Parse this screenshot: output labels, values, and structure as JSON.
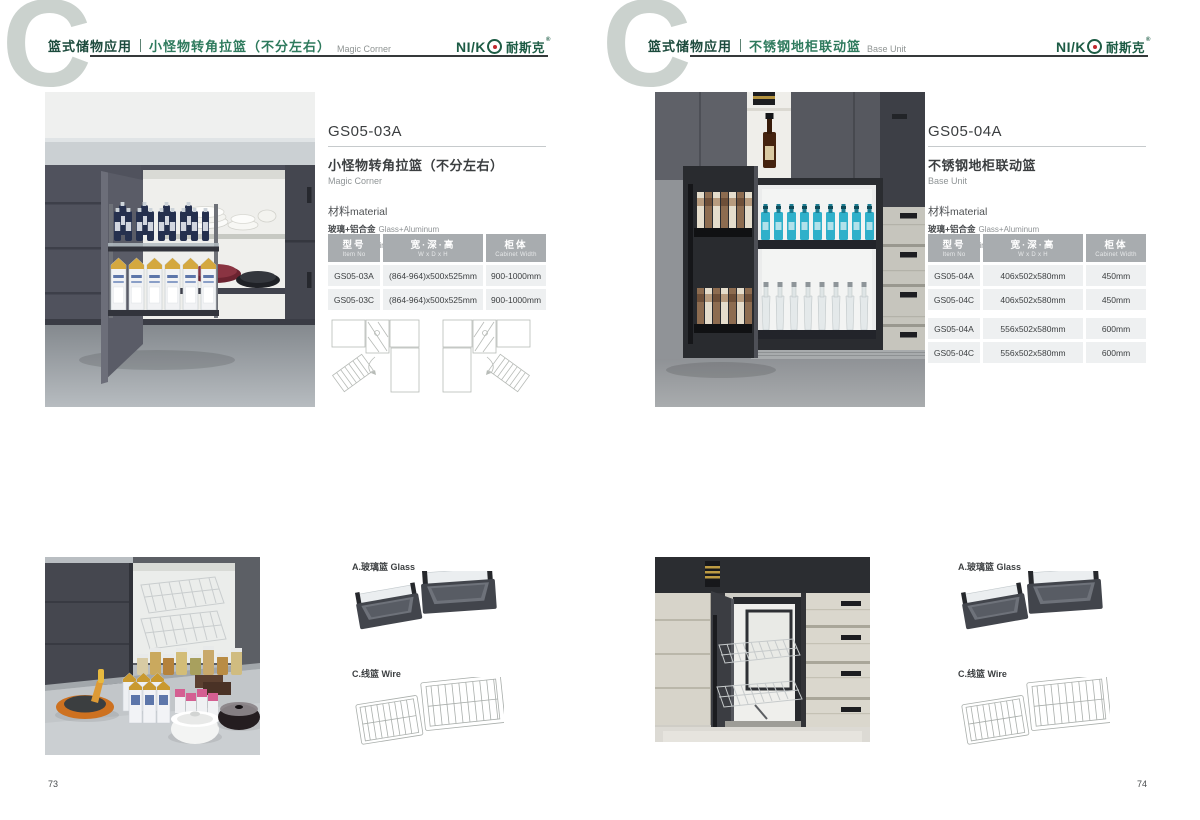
{
  "brand": {
    "latin": "NI/K",
    "cn": "耐斯克",
    "reg": "®"
  },
  "colors": {
    "brand_green": "#1d5c45",
    "title_green": "#2e7a5d",
    "logo_red": "#c1272d",
    "table_header_bg": "#a8acaf",
    "table_row_bg": "#eef0f1",
    "watermark_gray": "#cbd2ce"
  },
  "pages": [
    {
      "page_number": "73",
      "watermark": "C",
      "header": {
        "category": "篮式储物应用",
        "title_cn": "小怪物转角拉篮（不分左右）",
        "title_en": "Magic Corner"
      },
      "product": {
        "code": "GS05-03A",
        "name_cn": "小怪物转角拉篮（不分左右）",
        "name_en": "Magic Corner",
        "material_label_cn": "材料",
        "material_label_en": "material",
        "materials": [
          {
            "cn": "玻璃+铝合金",
            "en": "Glass+Aluminum"
          },
          {
            "cn": "不锈钢/铁",
            "en": "Stainless SteeL/Iron"
          }
        ]
      },
      "table": {
        "headers": [
          {
            "cn": "型号",
            "en": "Item No"
          },
          {
            "cn": "宽·深·高",
            "en": "W x D x H"
          },
          {
            "cn": "柜体",
            "en": "Cabinet Width"
          }
        ],
        "rows": [
          [
            "GS05-03A",
            "(864-964)x500x525mm",
            "900-1000mm"
          ],
          [
            "GS05-03C",
            "(864-964)x500x525mm",
            "900-1000mm"
          ]
        ]
      },
      "accessories": {
        "glass": "A.玻璃篮 Glass",
        "wire": "C.线篮 Wire"
      }
    },
    {
      "page_number": "74",
      "watermark": "C",
      "header": {
        "category": "篮式储物应用",
        "title_cn": "不锈钢地柜联动篮",
        "title_en": "Base Unit"
      },
      "product": {
        "code": "GS05-04A",
        "name_cn": "不锈钢地柜联动篮",
        "name_en": "Base Unit",
        "material_label_cn": "材料",
        "material_label_en": "material",
        "materials": [
          {
            "cn": "玻璃+铝合金",
            "en": "Glass+Aluminum"
          },
          {
            "cn": "不锈钢/铁",
            "en": "Stainless SteeL/Iron"
          }
        ]
      },
      "table": {
        "headers": [
          {
            "cn": "型号",
            "en": "Item No"
          },
          {
            "cn": "宽·深·高",
            "en": "W x D x H"
          },
          {
            "cn": "柜体",
            "en": "Cabinet Width"
          }
        ],
        "rows": [
          [
            "GS05-04A",
            "406x502x580mm",
            "450mm"
          ],
          [
            "GS05-04C",
            "406x502x580mm",
            "450mm"
          ],
          [
            "GS05-04A",
            "556x502x580mm",
            "600mm"
          ],
          [
            "GS05-04C",
            "556x502x580mm",
            "600mm"
          ]
        ]
      },
      "accessories": {
        "glass": "A.玻璃篮 Glass",
        "wire": "C.线篮 Wire"
      }
    }
  ]
}
